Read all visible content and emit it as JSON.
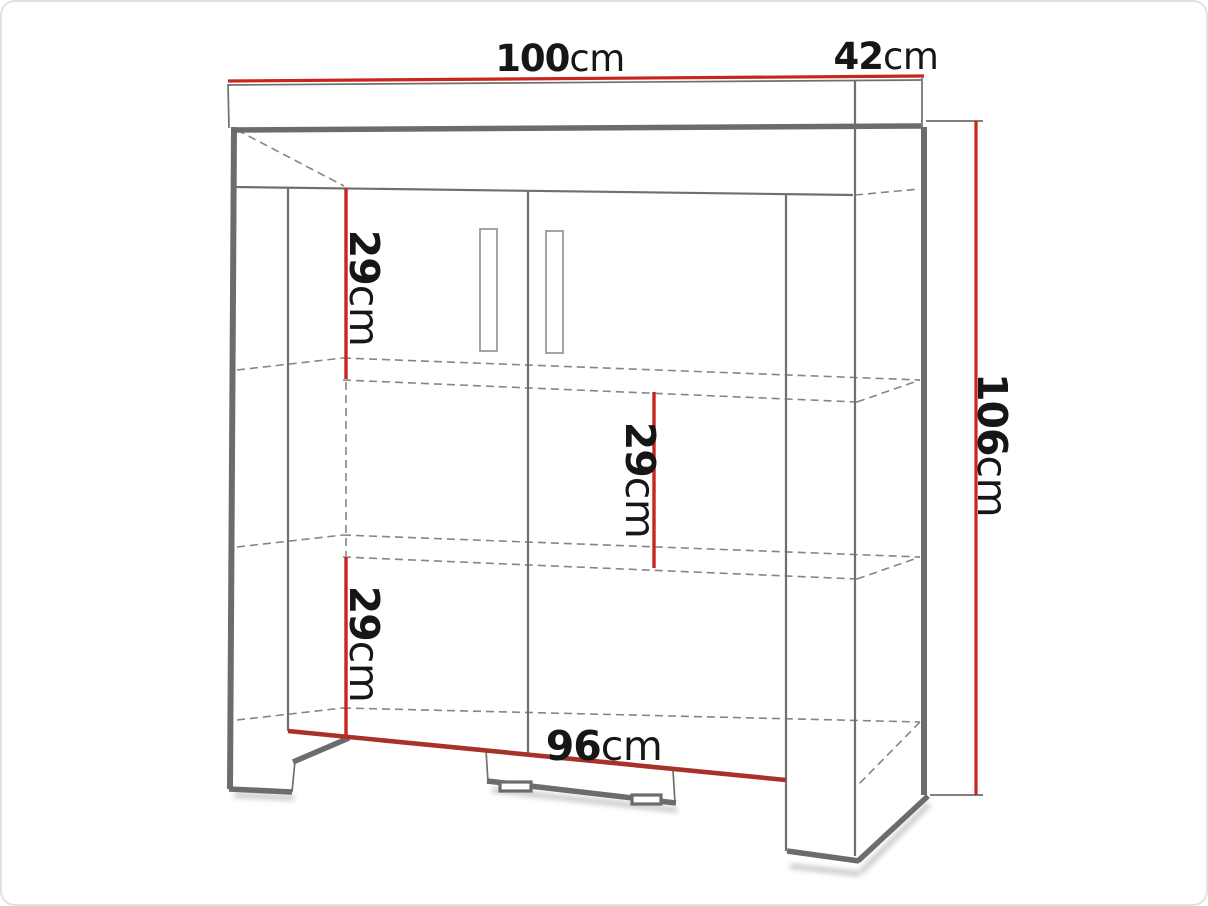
{
  "dimensions": {
    "top_width": {
      "value": "100",
      "unit": "cm"
    },
    "top_depth": {
      "value": "42",
      "unit": "cm"
    },
    "height": {
      "value": "106",
      "unit": "cm"
    },
    "shelf_top": {
      "value": "29",
      "unit": "cm"
    },
    "shelf_middle": {
      "value": "29",
      "unit": "cm"
    },
    "shelf_bottom": {
      "value": "29",
      "unit": "cm"
    },
    "bottom_width": {
      "value": "96",
      "unit": "cm"
    }
  },
  "colors": {
    "dimension_red": "#c8251f",
    "dimension_red_dark": "#a83228",
    "outline": "#6c6c6c",
    "thin": "#6f6f6f",
    "dashed": "#858585",
    "text": "#161616",
    "background": "#ffffff"
  }
}
